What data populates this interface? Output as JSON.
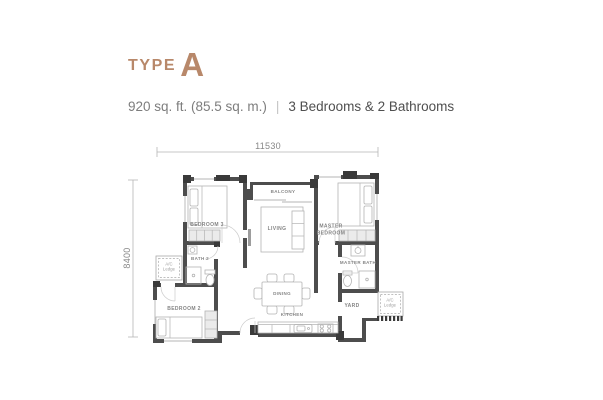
{
  "header": {
    "type_label": "TYPE",
    "type_letter": "A",
    "area_text": "920 sq. ft. (85.5 sq. m.)",
    "separator": "|",
    "features_text": "3 Bedrooms & 2 Bathrooms"
  },
  "dimensions": {
    "top": "11530",
    "left": "8400"
  },
  "rooms": {
    "balcony": "BALCONY",
    "living": "LIVING",
    "dining": "DINING",
    "kitchen": "KITCHEN",
    "bedroom3": "BEDROOM 3",
    "bath2": "BATH 2",
    "bedroom2": "BEDROOM 2",
    "master_line1": "MASTER",
    "master_line2": "BEDROOM",
    "master_bath": "MASTER BATH",
    "yard": "YARD"
  },
  "ac_ledge": {
    "line1": "A/C",
    "line2": "Ledge"
  },
  "colors": {
    "accent": "#b8886a",
    "wall": "#4d4d4d",
    "wall-dark": "#3a3a3a",
    "furniture": "#b4b4b4",
    "label": "#858585",
    "dim": "#b5b5b5"
  }
}
